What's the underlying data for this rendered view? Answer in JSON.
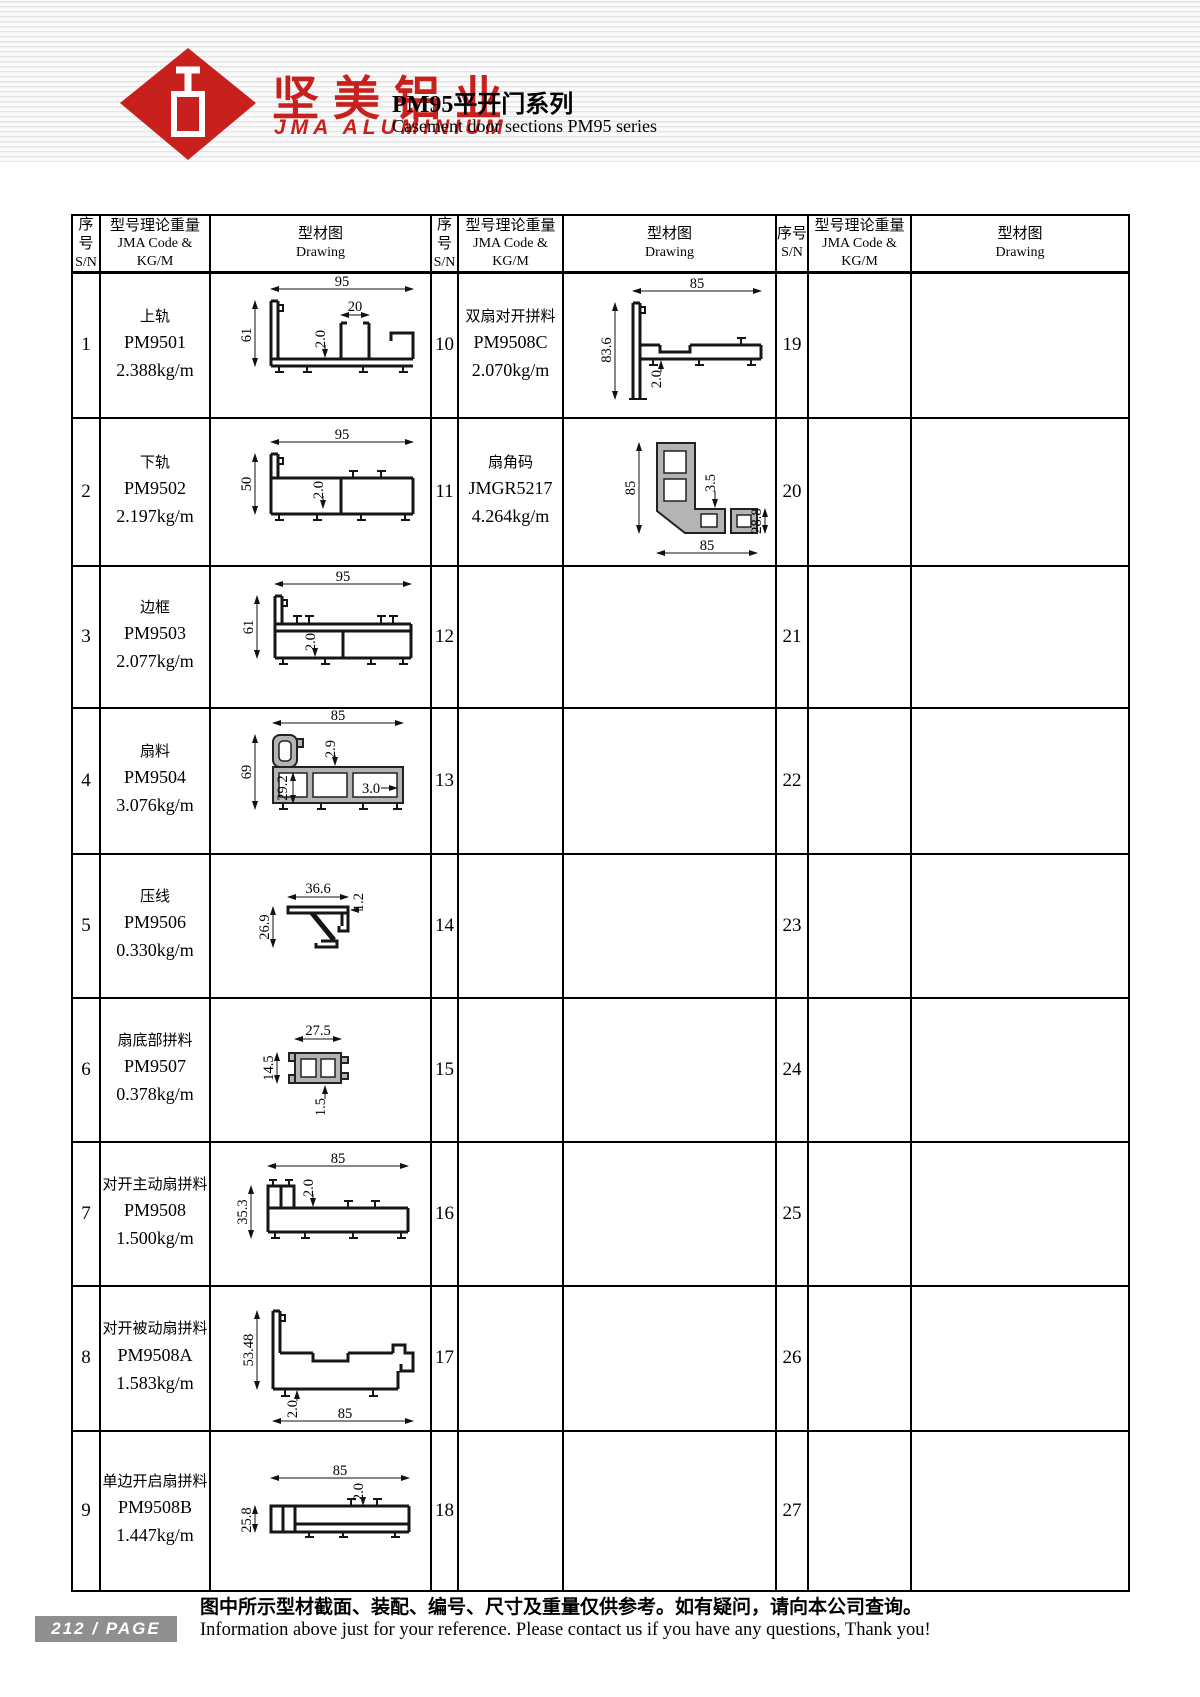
{
  "header": {
    "brand_cn": "坚美铝业",
    "brand_en": "JMA ALUMINIUM",
    "brand_color": "#c8201d",
    "title_cn": "PM95平开门系列",
    "title_en": "Casement door sections PM95 series"
  },
  "table_headers": {
    "sn_cn": "序号",
    "sn_en": "S/N",
    "code_cn": "型号理论重量",
    "code_en": "JMA Code & KG/M",
    "drawing_cn": "型材图",
    "drawing_en": "Drawing"
  },
  "groups": [
    {
      "rows": [
        {
          "sn": "1",
          "name": "上轨",
          "code": "PM9501",
          "weight": "2.388kg/m",
          "dims": {
            "a": "95",
            "b": "20",
            "c": "61",
            "d": "2.0"
          }
        },
        {
          "sn": "2",
          "name": "下轨",
          "code": "PM9502",
          "weight": "2.197kg/m",
          "dims": {
            "a": "95",
            "c": "50",
            "d": "2.0"
          }
        },
        {
          "sn": "3",
          "name": "边框",
          "code": "PM9503",
          "weight": "2.077kg/m",
          "dims": {
            "a": "95",
            "c": "61",
            "d": "2.0"
          }
        },
        {
          "sn": "4",
          "name": "扇料",
          "code": "PM9504",
          "weight": "3.076kg/m",
          "dims": {
            "a": "85",
            "c": "69",
            "d": "2.9",
            "e": "29.2",
            "f": "3.0"
          }
        },
        {
          "sn": "5",
          "name": "压线",
          "code": "PM9506",
          "weight": "0.330kg/m",
          "dims": {
            "a": "36.6",
            "b": "1.2",
            "c": "26.9"
          }
        },
        {
          "sn": "6",
          "name": "扇底部拼料",
          "code": "PM9507",
          "weight": "0.378kg/m",
          "dims": {
            "a": "27.5",
            "c": "14.5",
            "d": "1.5"
          }
        },
        {
          "sn": "7",
          "name": "对开主动扇拼料",
          "code": "PM9508",
          "weight": "1.500kg/m",
          "dims": {
            "a": "85",
            "c": "35.3",
            "d": "2.0"
          }
        },
        {
          "sn": "8",
          "name": "对开被动扇拼料",
          "code": "PM9508A",
          "weight": "1.583kg/m",
          "dims": {
            "c": "53.48",
            "d": "2.0",
            "g": "85"
          }
        },
        {
          "sn": "9",
          "name": "单边开启扇拼料",
          "code": "PM9508B",
          "weight": "1.447kg/m",
          "dims": {
            "a": "85",
            "c": "25.8",
            "d": "2.0"
          }
        }
      ]
    },
    {
      "rows": [
        {
          "sn": "10",
          "name": "双扇对开拼料",
          "code": "PM9508C",
          "weight": "2.070kg/m",
          "dims": {
            "a": "85",
            "c": "83.6",
            "d": "2.0"
          }
        },
        {
          "sn": "11",
          "name": "扇角码",
          "code": "JMGR5217",
          "weight": "4.264kg/m",
          "dims": {
            "c": "85",
            "d": "3.5",
            "e": "28.8",
            "g": "85"
          }
        },
        {
          "sn": "12"
        },
        {
          "sn": "13"
        },
        {
          "sn": "14"
        },
        {
          "sn": "15"
        },
        {
          "sn": "16"
        },
        {
          "sn": "17"
        },
        {
          "sn": "18"
        }
      ]
    },
    {
      "rows": [
        {
          "sn": "19"
        },
        {
          "sn": "20"
        },
        {
          "sn": "21"
        },
        {
          "sn": "22"
        },
        {
          "sn": "23"
        },
        {
          "sn": "24"
        },
        {
          "sn": "25"
        },
        {
          "sn": "26"
        },
        {
          "sn": "27"
        }
      ]
    }
  ],
  "footer": {
    "page_badge": "212  /  PAGE",
    "note_cn": "图中所示型材截面、装配、编号、尺寸及重量仅供参考。如有疑问，请向本公司查询。",
    "note_en": "Information above just for your reference. Please contact us if you have any questions, Thank you!"
  }
}
